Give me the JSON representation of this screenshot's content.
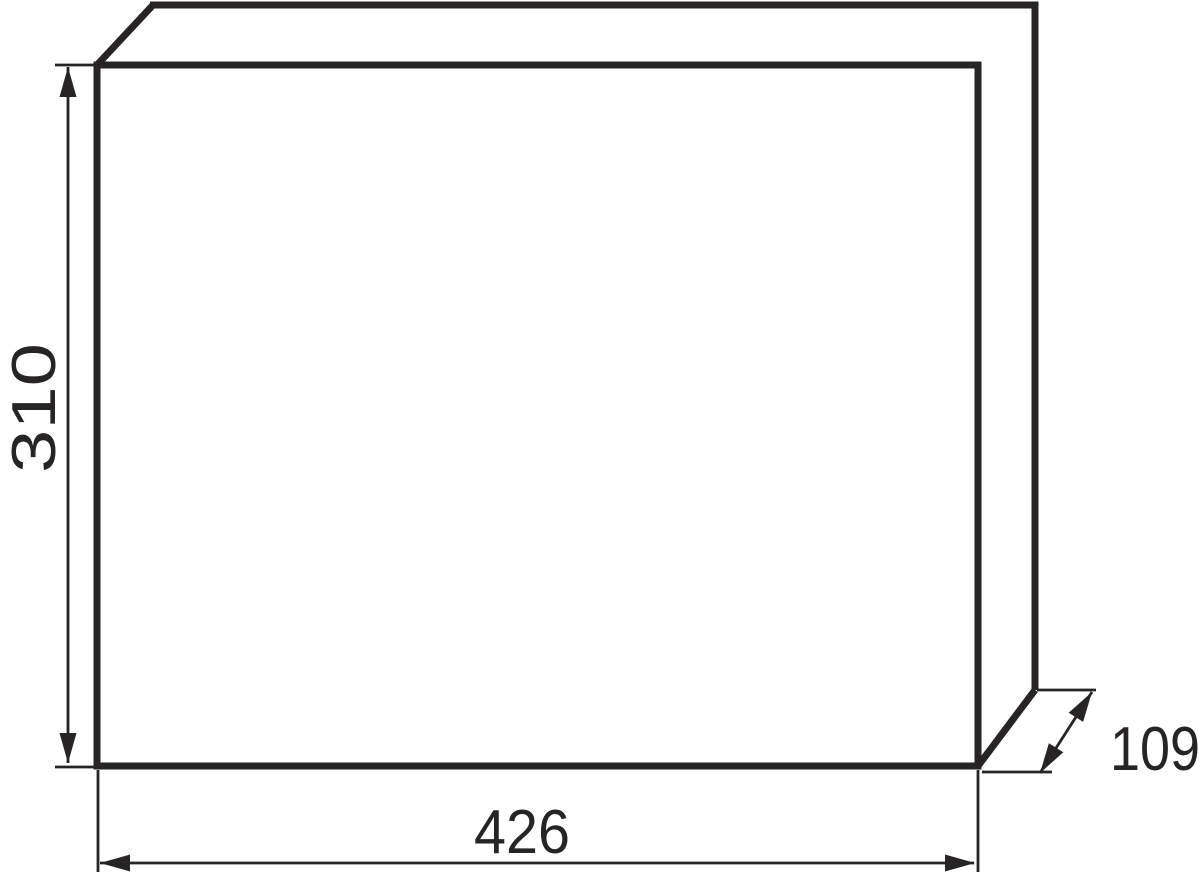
{
  "drawing": {
    "description": "technical-dimension-drawing-of-rectangular-enclosure",
    "background_color": "#ffffff",
    "line_color": "#272425",
    "labels": {
      "height": "310",
      "width": "426",
      "depth": "109"
    }
  }
}
